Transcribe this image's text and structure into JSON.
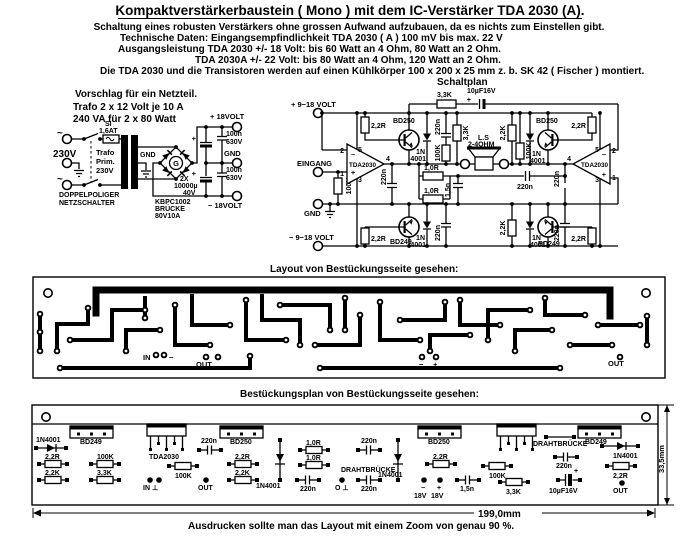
{
  "header": {
    "title": "Kompaktverstärkerbaustein ( Mono )  mit dem IC-Verstärker TDA 2030 (A).",
    "line1": "Schaltung eines robusten Verstärkers ohne grossen Aufwand aufzubauen, da es nichts zum Einstellen gibt.",
    "line2": "Technische Daten: Eingangsempfindlichkeit TDA 2030 ( A ) 100 mV bis max. 22 V",
    "line3": "Ausgangsleistung TDA 2030   +/- 18 Volt: bis 60 Watt an 4 Ohm,  80 Watt an 2 Ohm.",
    "line4": "TDA 2030A +/- 22 Volt: bis 80 Watt an 4 Ohm, 120 Watt an 2 Ohm.",
    "line5": "Die TDA 2030 und die Transistoren werden auf einen Kühlkörper 100 x 200 x 25 mm z. b. SK 42 ( Fischer ) montiert.",
    "schaltplan_caption": "Schaltplan"
  },
  "psu": {
    "note1": "Vorschlag für ein Netzteil.",
    "note2": "Trafo 2 x 12 Volt je 10 A",
    "note3": "240 VA für 2 x 80 Watt",
    "mains_voltage": "230V",
    "ac_symbol": "~",
    "fuse_name": "SI",
    "fuse_rating": "1,6AT",
    "trafo1": "Trafo",
    "trafo2": "Prim.",
    "trafo3": "230V",
    "gnd": "GND",
    "switch1": "DOPPELPOLIGER",
    "switch2": "NETZSCHALTER",
    "bridge_g": "G",
    "bridge1": "KBPC1002",
    "bridge2": "BRÜCKE",
    "bridge3": "80V10A",
    "bigcap1": "2X",
    "bigcap2": "10000µ",
    "bigcap3": "40V",
    "filmcap": "100n",
    "filmcap_v": "630V",
    "out_pos": "+ 18VOLT",
    "out_gnd": "GND",
    "out_neg": "− 18VOLT"
  },
  "sch": {
    "v_pos": "+ 9−18 VOLT",
    "v_neg": "− 9−18 VOLT",
    "input": "EINGANG",
    "gnd": "GND",
    "speaker1": "L.S",
    "speaker2": "2-4OHM"
  },
  "labels": {
    "r22": "2,2R",
    "r22k": "2,2K",
    "r33k": "3,3K",
    "r10": "1,0R",
    "r100k": "100K",
    "c220n": "220n",
    "c15n": "1,5n",
    "c10u": "10µF16V",
    "d1n": "1N",
    "d4001": "4001",
    "d1n4001": "1N4001",
    "bd250": "BD250",
    "bd249": "BD249",
    "tda2030": "TDA2030",
    "p1": "1",
    "p2": "2",
    "p3": "3",
    "p4": "4",
    "p5": "5",
    "minus": "−",
    "plus": "+"
  },
  "layout": {
    "caption": "Layout von Bestückungsseite gesehen:",
    "in": "IN",
    "out": "OUT",
    "minus": "−",
    "plus": "+"
  },
  "bp": {
    "caption": "Bestückungsplan von Bestückungsseite gesehen:",
    "jumper": "DRAHTBRÜCKE",
    "in_gnd": "IN ⊥",
    "o_gnd": "O ⊥",
    "out": "OUT",
    "v18": "18V",
    "dim_width": "199,0mm",
    "dim_height": "33,5mm"
  },
  "footer": {
    "note": "Ausdrucken sollte man das Layout mit einem Zoom von  genau 90 %."
  }
}
